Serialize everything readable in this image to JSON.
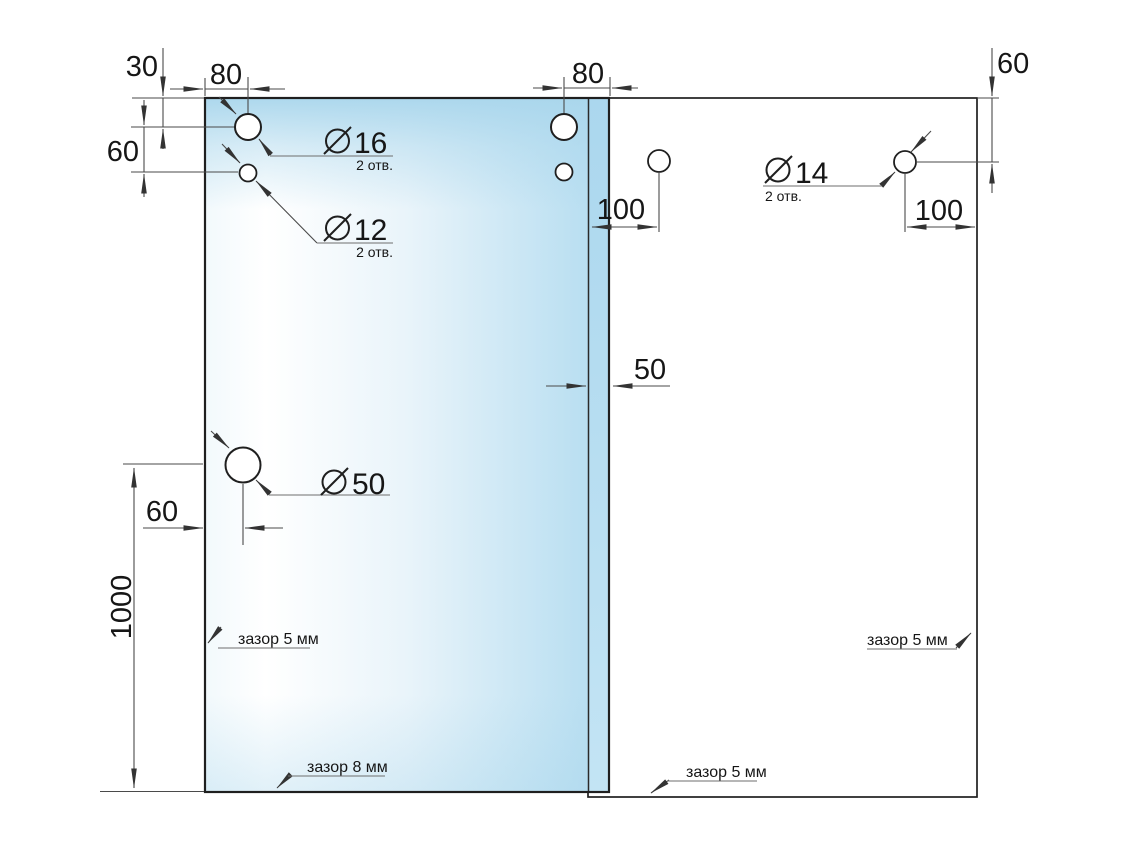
{
  "labels": {
    "dims": {
      "top_edge_to_hole": "30",
      "left_edge_to_hole": "80",
      "hole_spacing_vertical": "60",
      "hole_to_overlap_edge": "80",
      "right_top_edge_to_hole": "60",
      "overlap_to_hole": "100",
      "hole_to_right_edge": "100",
      "panel_overlap": "50",
      "left_edge_to_big_hole": "60",
      "big_hole_to_bottom": "1000"
    },
    "holes": {
      "dia16": {
        "diameter": "16",
        "count": "2 отв."
      },
      "dia12": {
        "diameter": "12",
        "count": "2 отв."
      },
      "dia14": {
        "diameter": "14",
        "count": "2 отв."
      },
      "dia50": {
        "diameter": "50"
      }
    },
    "gaps": {
      "left": "зазор 5 мм",
      "bottom_left": "зазор 8 мм",
      "bottom_middle": "зазор 5 мм",
      "right": "зазор 5 мм"
    }
  },
  "colors": {
    "background": "#ffffff",
    "glass_blue": "#b3dcf0",
    "glass_highlight": "#ffffff",
    "overlap_strip": "#abd7ee",
    "panel_outline": "#1f1f1f",
    "dimension_lines": "#4a4a4a",
    "text": "#161616"
  }
}
